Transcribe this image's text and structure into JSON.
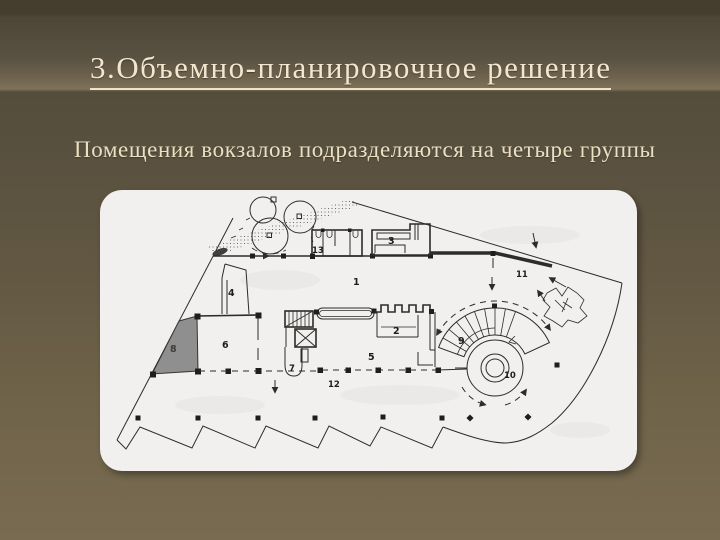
{
  "slide": {
    "title": "3.Объемно-планировочное решение",
    "subtitle": "Помещения вокзалов подразделяются на четыре группы"
  },
  "colors": {
    "background_top": "#453e2f",
    "background_bottom": "#786b51",
    "band_light": "#7f7259",
    "title_text": "#f1e7cf",
    "subtitle_text": "#ecdfc2",
    "panel_background": "#f1f0ee",
    "plan_ink": "#2e2c29",
    "room8_fill": "#8f8f8f"
  },
  "plan": {
    "labels": {
      "l1": "1",
      "l2": "2",
      "l3": "3",
      "l4": "4",
      "l5": "5",
      "l6": "6",
      "l7": "7",
      "l8": "8",
      "l9": "9",
      "l10": "10",
      "l11": "11",
      "l12": "12",
      "l13": "13"
    }
  }
}
